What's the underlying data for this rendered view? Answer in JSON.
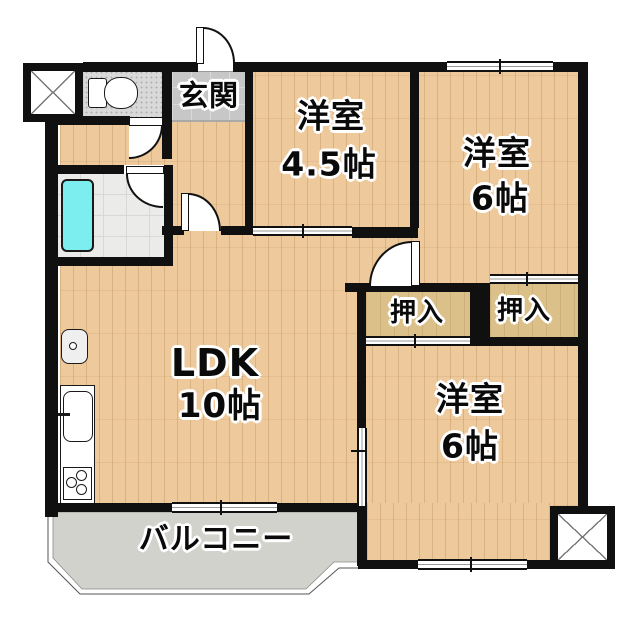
{
  "plan": {
    "type": "floor-plan",
    "rooms": [
      {
        "id": "genkan",
        "label": "玄関"
      },
      {
        "id": "western-room-4-5",
        "label": "洋室",
        "size": "4.5帖"
      },
      {
        "id": "western-room-6-top",
        "label": "洋室",
        "size": "6帖"
      },
      {
        "id": "closet-left",
        "label": "押入"
      },
      {
        "id": "closet-right",
        "label": "押入"
      },
      {
        "id": "ldk",
        "label": "LDK",
        "size": "10帖"
      },
      {
        "id": "western-room-6-bottom",
        "label": "洋室",
        "size": "6帖"
      },
      {
        "id": "balcony",
        "label": "バルコニー"
      }
    ],
    "colors": {
      "wall": "#101010",
      "wood_floor": "#edc99c",
      "closet": "#dbc08a",
      "balcony": "#d0d2cb",
      "entry_tile": "#c7c7c7",
      "bath_tile": "#ebebe9",
      "bathtub": "#7ceef0"
    }
  }
}
